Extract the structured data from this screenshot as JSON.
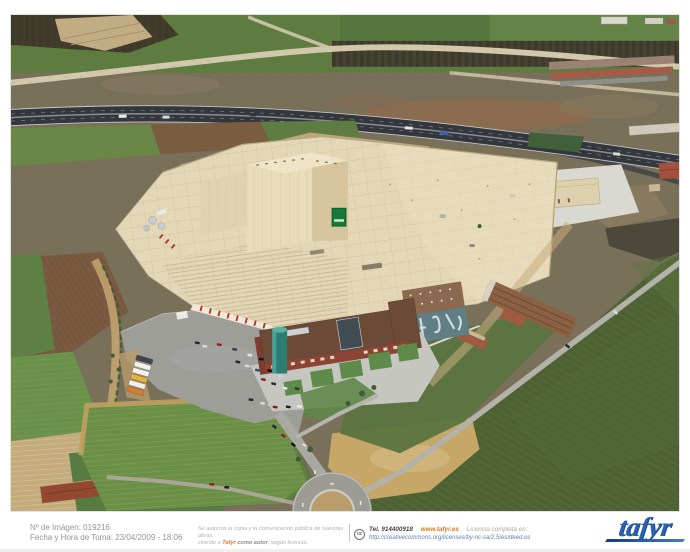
{
  "footer": {
    "image_number": "Nº de Imágen: 019216",
    "capture_datetime": "Fecha y Hora de Toma: 23/04/2009 - 18:06",
    "license_note_line1": "Se autoriza la copia y la comunicación pública de nuestras obras,",
    "license_note_line2_pre": "citando a ",
    "license_note_brand": "Tafyr",
    "license_note_line2_bold": " como autor",
    "license_note_line2_end": ", según licencia.",
    "cc_glyph": "cc",
    "phone": "Tel. 914400918",
    "website": "www.tafyr.es",
    "license_link_label": "Licencia completa en:",
    "license_url": "http://creativecommons.org/licenses/by-nc-sa/2.5/es/deed.es",
    "logo_text": "tafyr"
  },
  "photo": {
    "alt": "Oblique aerial photograph of a large factory complex with cream rooftops, a tall high-bay warehouse bearing a green sign, a red-brick office building with a teal tower, a car park with buses and cars, a dual-carriageway highway behind the plant, an access road and roundabout in front, surrounded by green and plowed farm fields and a row of bare trees."
  },
  "colors": {
    "brand_orange": "#e07820",
    "logo_blue": "#2a62ae",
    "link_blue": "#5b82b8",
    "footer_gray": "#949494",
    "roof_cream": "#e3d7b7",
    "field_green": "#5e7c40",
    "dark_field_green": "#4d6133",
    "highway_asphalt": "#33363c",
    "brick_red": "#8d4434",
    "teal_tower": "#2e7d74",
    "sign_green": "#157a38",
    "parking_gray": "#9e9e99",
    "dirt_tan": "#c4ad82"
  }
}
